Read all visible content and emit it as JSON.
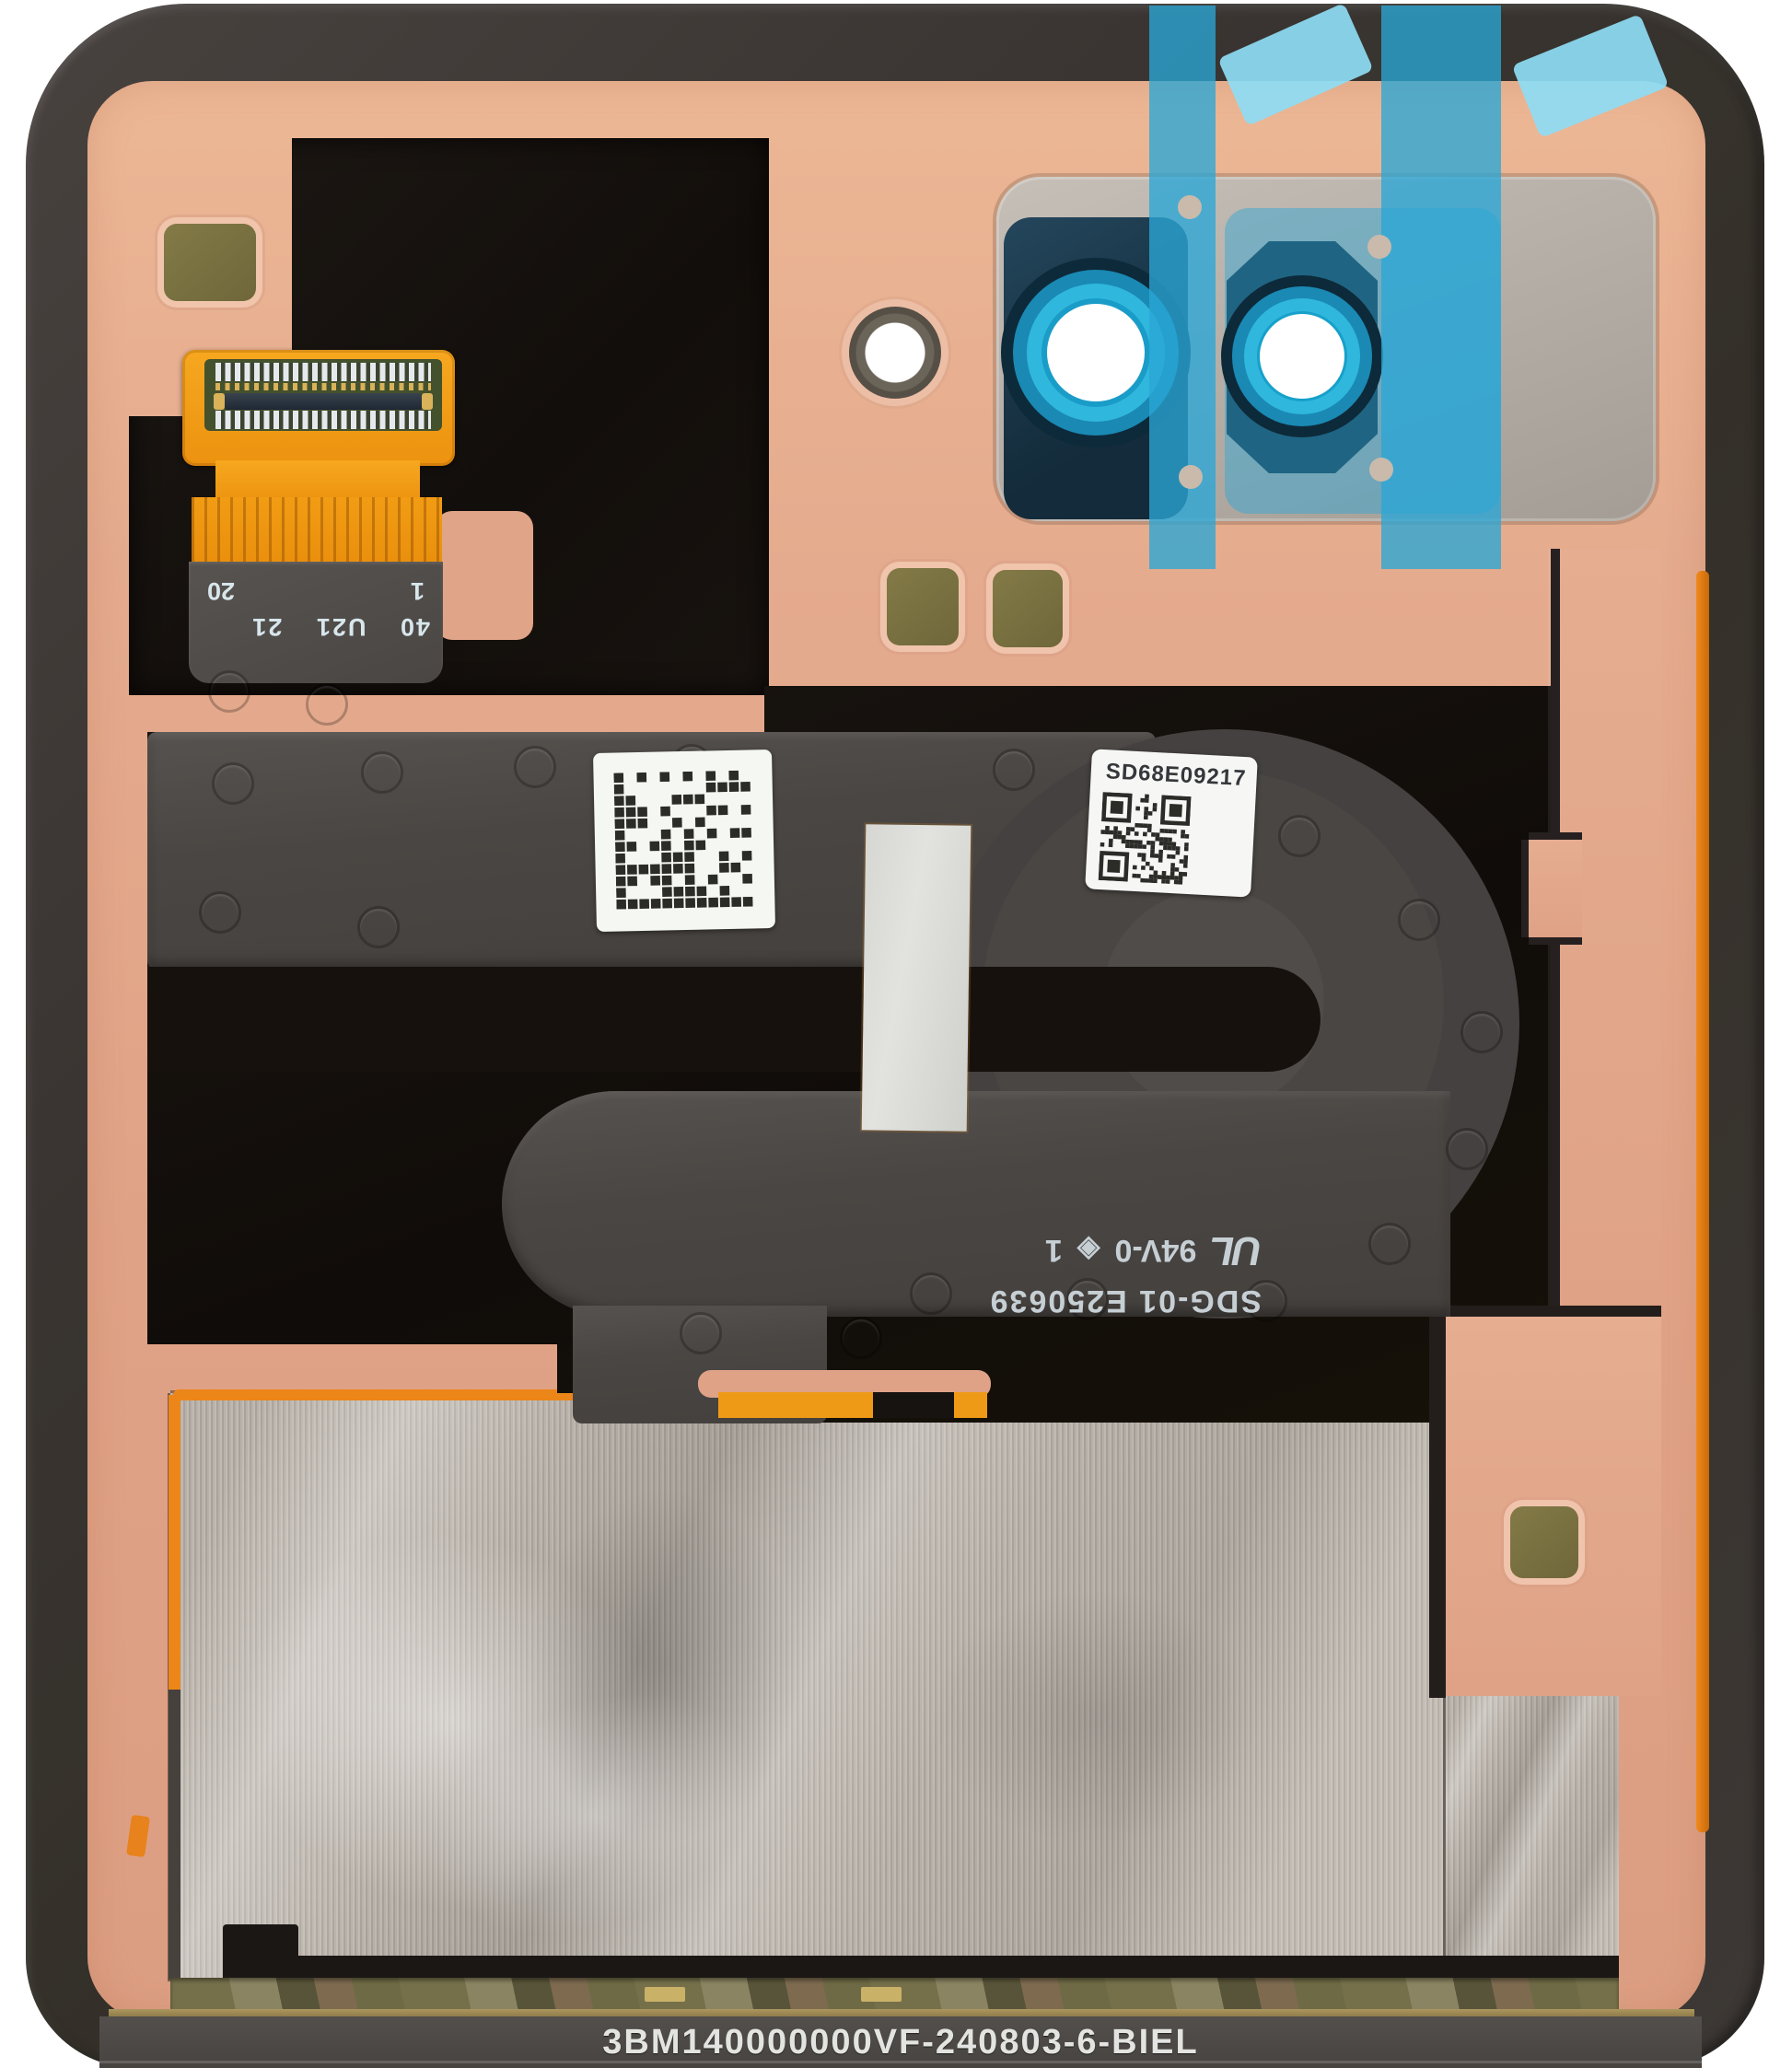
{
  "photo": {
    "description_labels": {
      "stiffener_print": {
        "line1": "40 U21 21",
        "left": "1",
        "right": "20"
      },
      "qr_label_text": "SD68E09217",
      "flex_print": {
        "line1": "SDG-01 E250639",
        "ul_mark": "UL",
        "rating": "94V-0",
        "diamond": "◈",
        "suffix": "1"
      },
      "bottom_part_number": "3BM140000000VF-240803-6-BIEL"
    },
    "colors": {
      "background": "#ffffff",
      "frame": "#3a3532",
      "copper_panel": "#e0a286",
      "adhesive_black": "#16110d",
      "flex_grey": "#4a4643",
      "kapton_orange": "#f09a14",
      "protective_film_blue": "#2aa7d6",
      "lens_ring_teal": "#2fb7dd",
      "camera_bezel_navy": "#16313f",
      "bracket_grey": "#b3aca4",
      "foil_silver": "#b3aca4",
      "pad_olive": "#7b7342",
      "gold_trim": "#97824e"
    }
  }
}
